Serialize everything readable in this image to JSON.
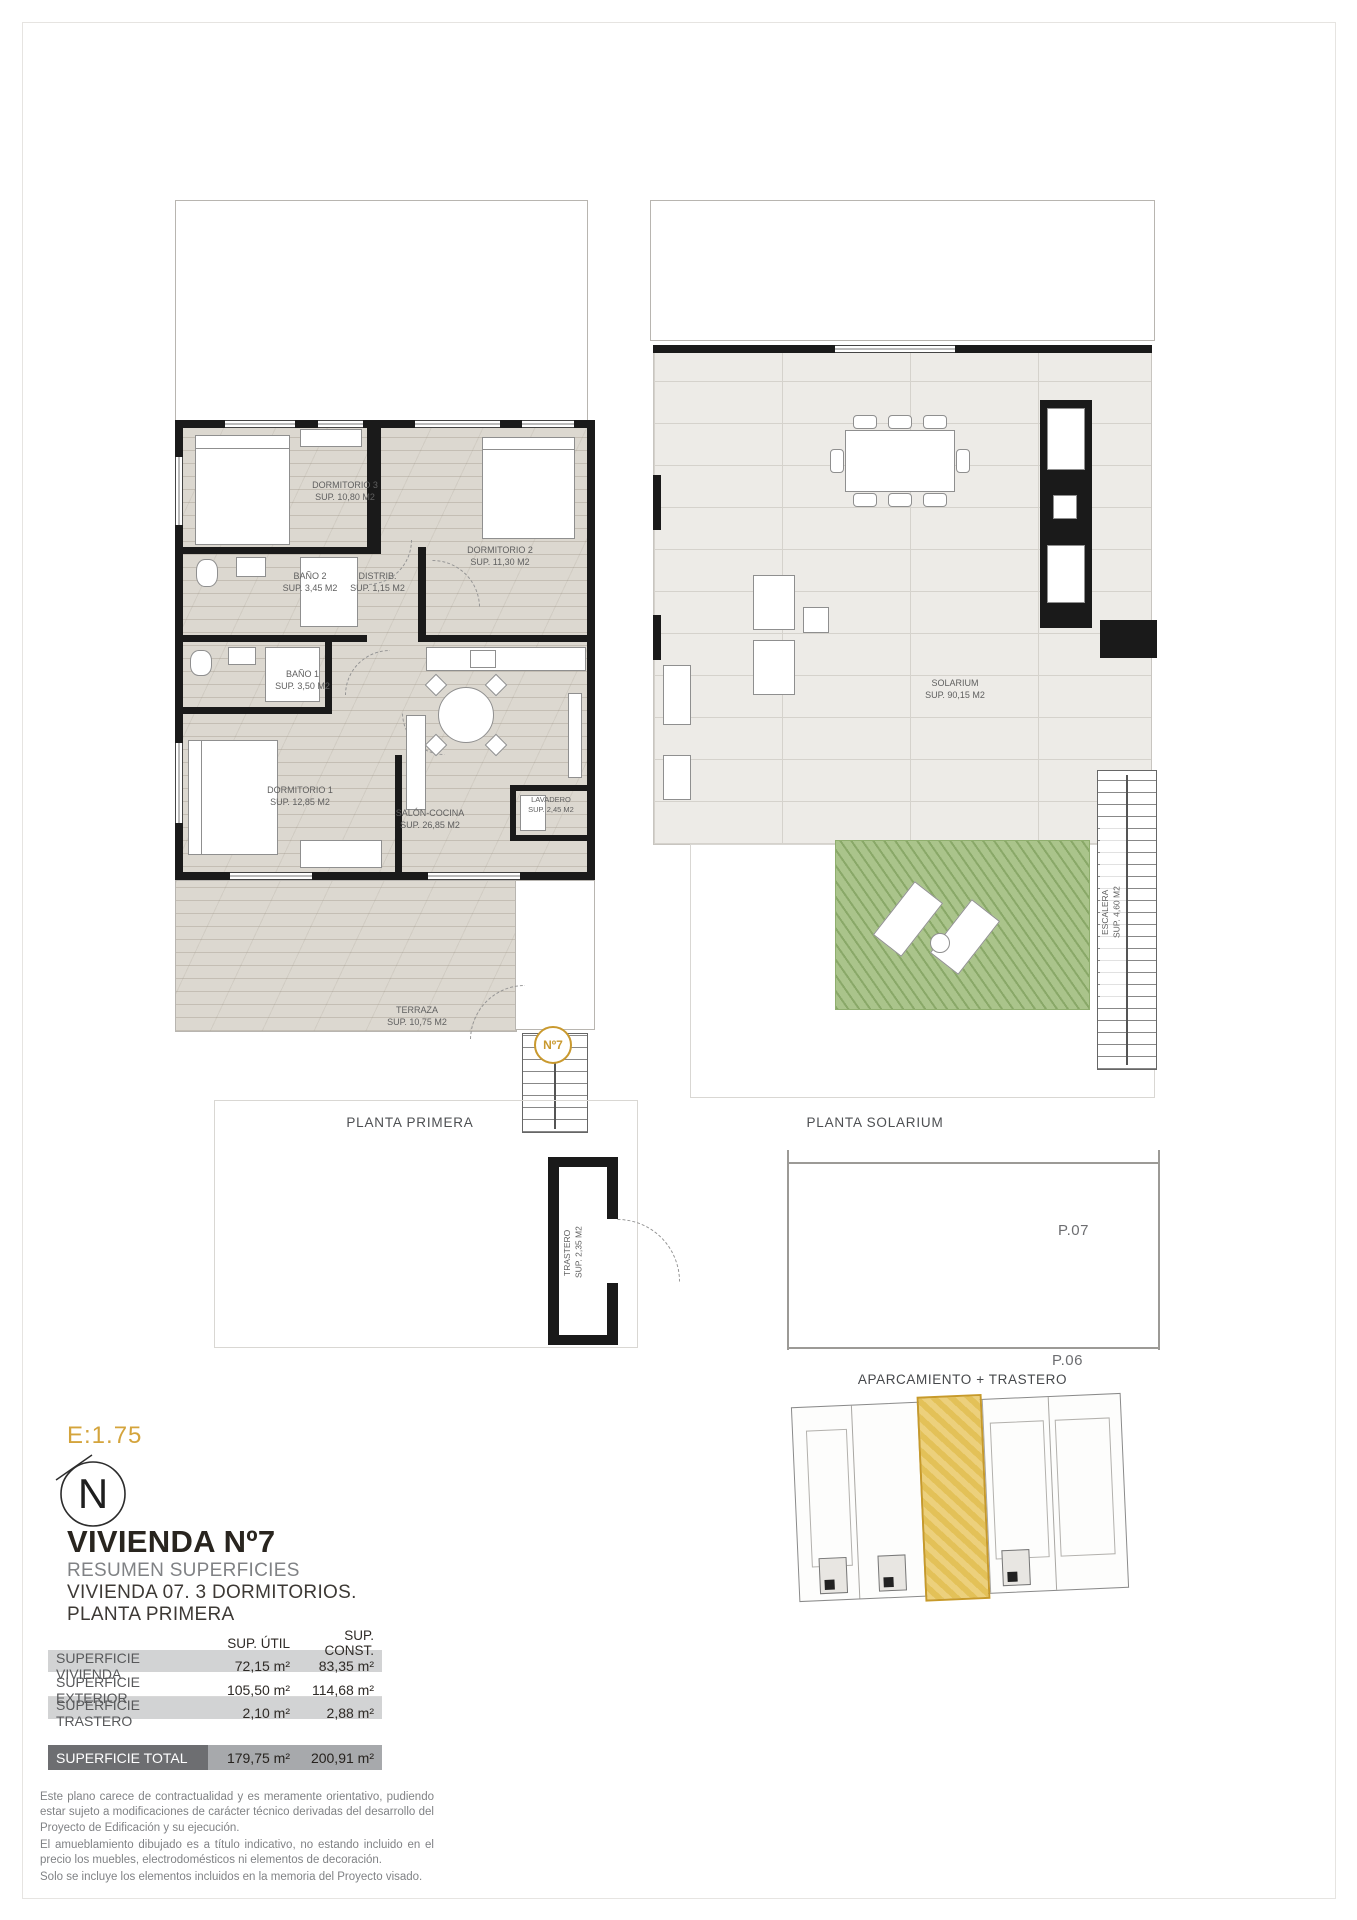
{
  "frame": {
    "scale_label": "E:1.75",
    "north_letter": "N"
  },
  "plans": {
    "left": {
      "caption": "PLANTA PRIMERA",
      "badge": "Nº7",
      "rooms": {
        "d3": {
          "name": "DORMITORIO 3",
          "area": "SUP. 10,80 M2"
        },
        "d2": {
          "name": "DORMITORIO 2",
          "area": "SUP. 11,30 M2"
        },
        "b2": {
          "name": "BAÑO 2",
          "area": "SUP. 3,45 M2"
        },
        "dist": {
          "name": "DISTRIB.",
          "area": "SUP. 1,15 M2"
        },
        "b1": {
          "name": "BAÑO 1",
          "area": "SUP. 3,50 M2"
        },
        "d1": {
          "name": "DORMITORIO 1",
          "area": "SUP. 12,85 M2"
        },
        "salon": {
          "name": "SALÓN-COCINA",
          "area": "SUP. 26,85 M2"
        },
        "lav": {
          "name": "LAVADERO",
          "area": "SUP. 2,45 M2"
        },
        "terraza": {
          "name": "TERRAZA",
          "area": "SUP. 10,75 M2"
        }
      }
    },
    "right": {
      "caption": "PLANTA SOLARIUM",
      "rooms": {
        "solarium": {
          "name": "SOLARIUM",
          "area": "SUP. 90,15 M2"
        },
        "escalera": {
          "name": "ESCALERA",
          "area": "SUP. 4,60 M2"
        }
      }
    }
  },
  "info": {
    "title": "VIVIENDA Nº7",
    "subtitle1": "RESUMEN SUPERFICIES",
    "subtitle2": "VIVIENDA 07. 3 DORMITORIOS.",
    "subtitle3": "PLANTA PRIMERA"
  },
  "surface_table": {
    "col_util": "SUP. ÚTIL",
    "col_const": "SUP. CONST.",
    "rows": [
      {
        "label": "SUPERFICIE VIVIENDA",
        "util": "72,15 m²",
        "const": "83,35 m²"
      },
      {
        "label": "SUPERFICIE EXTERIOR",
        "util": "105,50 m²",
        "const": "114,68 m²"
      },
      {
        "label": "SUPERFICIE TRASTERO",
        "util": "2,10 m²",
        "const": "2,88 m²"
      }
    ],
    "total": {
      "label": "SUPERFICIE TOTAL",
      "util": "179,75 m²",
      "const": "200,91 m²"
    }
  },
  "disclaimer": {
    "p1": "Este plano carece de contractualidad y es meramente orientativo, pudiendo estar sujeto a modificaciones de carácter técnico derivadas del desarrollo del Proyecto de Edificación y su ejecución.",
    "p2": "El amueblamiento dibujado es a título indicativo, no estando incluido en el precio los muebles, electrodomésticos ni elementos de decoración.",
    "p3": "Solo se incluye los elementos incluidos en la memoria del Proyecto visado."
  },
  "parking": {
    "trastero_name": "TRASTERO",
    "trastero_area": "SUP. 2,35 M2",
    "space_top": "P.07",
    "space_bottom": "P.06",
    "caption": "APARCAMIENTO + TRASTERO"
  },
  "colors": {
    "accent_gold": "#c9992e",
    "scale_gold": "#d4a43c",
    "wall_black": "#1a1a1a",
    "lawn_green": "#aac48b",
    "row_gray": "#d2d3d4",
    "total_dark": "#6d6e71"
  }
}
